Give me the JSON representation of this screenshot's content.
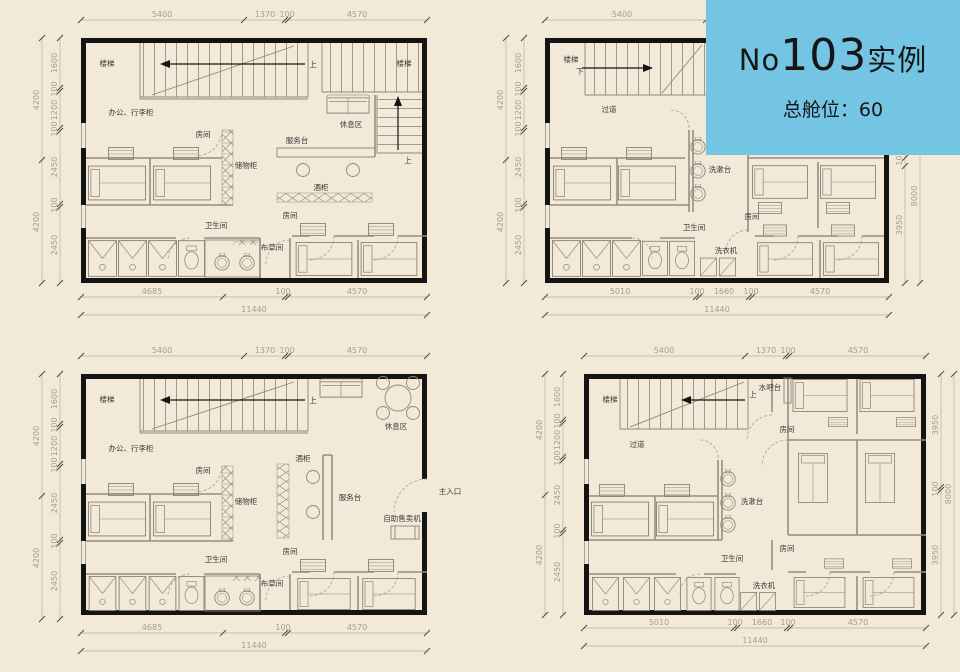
{
  "banner": {
    "prefix": "No",
    "number": "103",
    "suffix": "实例",
    "subtitle": "总舱位：60"
  },
  "colors": {
    "background": "#f2e9d8",
    "banner_bg": "#74c5e3",
    "wall": "#141414",
    "dim_text": "#ab9c89",
    "label_text": "#3a3a3a"
  },
  "plans": {
    "tl": {
      "labels": {
        "stairs_a": "楼梯",
        "up_a": "上",
        "stairs_b": "楼梯",
        "up_b": "上",
        "office": "办公、行李柜",
        "room_a": "房间",
        "storage": "储物柜",
        "service_desk": "服务台",
        "lounge": "休息区",
        "wine_cabinet": "酒柜",
        "toilet": "卫生间",
        "linen": "布草间",
        "room_b": "房间"
      },
      "dims": {
        "top": [
          "5400",
          "1370",
          "100",
          "4570"
        ],
        "left_outer": [
          "4200",
          "4200"
        ],
        "left_inner": [
          "1600",
          "100",
          "1200",
          "100",
          "2450",
          "100",
          "2450"
        ],
        "bottom": [
          "4685",
          "100",
          "4570"
        ],
        "total": "11440"
      }
    },
    "tr": {
      "labels": {
        "stairs": "楼梯",
        "down": "下",
        "corridor": "过道",
        "washstand": "洗漱台",
        "room_a": "房间",
        "toilet": "卫生间",
        "washer": "洗衣机"
      },
      "dims": {
        "top": [
          "5400"
        ],
        "left_outer": [
          "4200",
          "4200"
        ],
        "left_inner": [
          "1600",
          "100",
          "1200",
          "100",
          "2450",
          "100",
          "2450"
        ],
        "right_inner": [
          "100",
          "3950"
        ],
        "right_outer": [
          "8000"
        ],
        "bottom": [
          "5010",
          "100",
          "1660",
          "100",
          "4570"
        ],
        "total": "11440"
      }
    },
    "bl": {
      "labels": {
        "stairs": "楼梯",
        "up": "上",
        "office": "办公、行李柜",
        "room_a": "房间",
        "storage": "储物柜",
        "wine_cabinet": "酒柜",
        "service_desk": "服务台",
        "lounge": "休息区",
        "vending": "自助售卖机",
        "main_entrance": "主入口",
        "toilet": "卫生间",
        "linen": "布草间",
        "room_b": "房间"
      },
      "dims": {
        "top": [
          "5400",
          "1370",
          "100",
          "4570"
        ],
        "left_outer": [
          "4200",
          "4200"
        ],
        "left_inner": [
          "1600",
          "100",
          "1200",
          "100",
          "2450",
          "100",
          "2450"
        ],
        "bottom": [
          "4685",
          "100",
          "4570"
        ],
        "total": "11440"
      }
    },
    "br": {
      "labels": {
        "stairs": "楼梯",
        "up": "上",
        "water_bar": "水吧台",
        "room_a": "房间",
        "corridor": "过道",
        "washstand": "洗漱台",
        "toilet": "卫生间",
        "room_b": "房间",
        "washer": "洗衣机"
      },
      "dims": {
        "top": [
          "5400",
          "1370",
          "100",
          "4570"
        ],
        "left_outer": [
          "4200",
          "4200"
        ],
        "left_inner": [
          "1600",
          "100",
          "1200",
          "100",
          "2450",
          "100",
          "2450"
        ],
        "right_inner": [
          "3950",
          "100",
          "3950"
        ],
        "right_outer": [
          "8000"
        ],
        "bottom": [
          "5010",
          "100",
          "1660",
          "100",
          "4570"
        ],
        "total": "11440"
      }
    }
  }
}
